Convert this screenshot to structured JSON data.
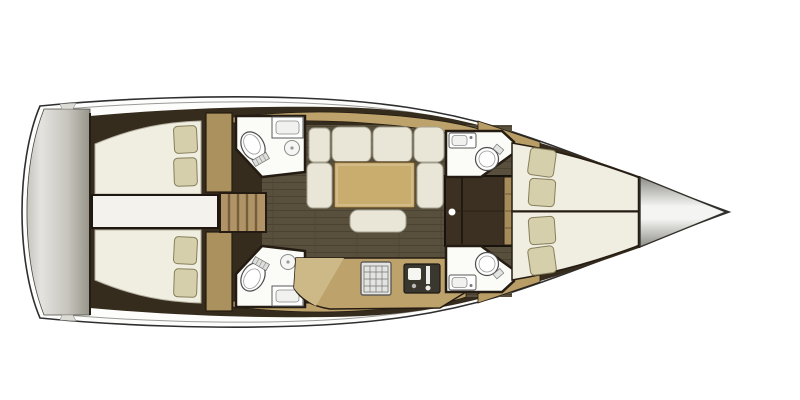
{
  "scene": "sailing-yacht-interior-floor-plan-top-view",
  "orientation": "bow-pointing-right",
  "palette": {
    "page_bg": "#ffffff",
    "hull_line": "#2f2f2f",
    "hull_fill": "#fdfdfc",
    "inner_line": "#9a9a96",
    "transom_light": "#e4e3df",
    "transom_mid": "#c6c4bc",
    "transom_dark": "#97948a",
    "wall_dark": "#362c1d",
    "wall_stroke": "#241c12",
    "floor": "#58503d",
    "floor_line": "#453e2e",
    "wood_band": "#bda26b",
    "wood_light": "#cdb987",
    "wood_door": "#ab915d",
    "stairs": "#b09468",
    "stair_tread": "#755f3a",
    "bed": "#f0ede1",
    "bed_line": "#b4b0a0",
    "pillow": "#d6cfac",
    "pillow_line": "#867f5c",
    "cushion": "#eae6d7",
    "cushion_line": "#a5a191",
    "table": "#c9ad6f",
    "table_line": "#5f4d2e",
    "room_white": "#fbfbf8",
    "fixture_line": "#5a5a5a",
    "stove": "#e3e3e0",
    "sink_dark": "#3a372e",
    "cone_dark": "#8e8e88",
    "cone_light": "#f4f4f2"
  },
  "vessel": {
    "sections": {
      "stern_platform": {
        "features": [
          "transom-swim-platform"
        ]
      },
      "aft_cabin_port": {
        "features": [
          "double-berth",
          "pillows"
        ],
        "pillow_count": 2
      },
      "aft_cabin_starboard": {
        "features": [
          "double-berth",
          "pillows"
        ],
        "pillow_count": 2
      },
      "engine_compartment": {
        "features": [
          "white-hatch-between-aft-cabins"
        ]
      },
      "companionway_stairs": {
        "tread_count": 5
      },
      "aft_head_port": {
        "fixtures": [
          "toilet",
          "sink",
          "shower-drain"
        ]
      },
      "aft_head_starboard": {
        "fixtures": [
          "toilet",
          "sink",
          "shower-drain"
        ]
      },
      "salon": {
        "furniture": [
          "sofa-back-cushions",
          "side-seat-cushions",
          "dining-table",
          "ottoman"
        ],
        "back_cushion_count": 4
      },
      "galley": {
        "fixtures": [
          "stove-grill",
          "sink-with-faucet"
        ]
      },
      "forward_head_port": {
        "fixtures": [
          "sink",
          "toilet"
        ]
      },
      "forward_head_starboard": {
        "fixtures": [
          "sink",
          "toilet"
        ]
      },
      "forward_cabin_port_berth": {
        "features": [
          "v-berth",
          "pillows"
        ],
        "pillow_count": 2
      },
      "forward_cabin_starboard_berth": {
        "features": [
          "v-berth",
          "pillows"
        ],
        "pillow_count": 2
      },
      "bow_locker": {
        "features": [
          "anchor-locker-cone"
        ]
      }
    }
  }
}
